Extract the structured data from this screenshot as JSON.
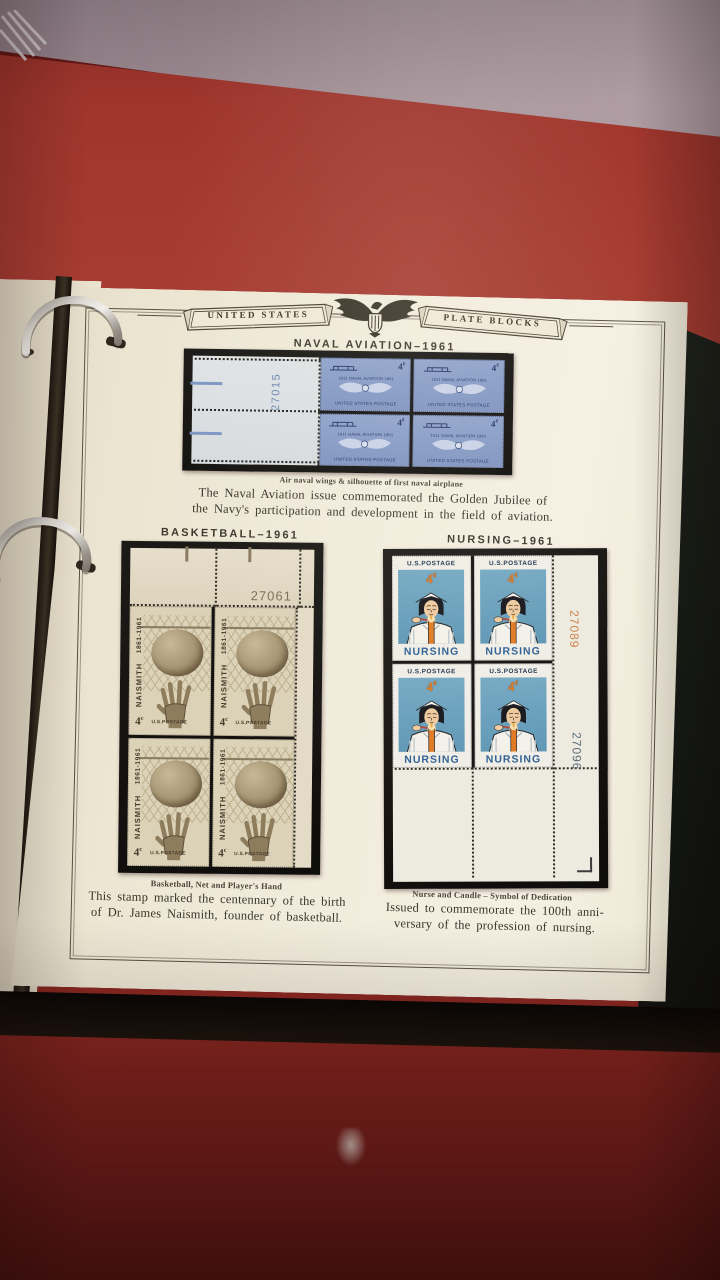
{
  "page_header": {
    "left_banner": "UNITED STATES",
    "right_banner": "PLATE BLOCKS",
    "emblem_icon": "eagle-with-shield"
  },
  "naval_section": {
    "title": "NAVAL AVIATION–1961",
    "plate_number": "27015",
    "stamp": {
      "center_text": "1911 NAVAL AVIATION 1961",
      "denomination": "4",
      "cent_symbol": "¢",
      "bottom_text": "UNITED STATES POSTAGE"
    },
    "caption": "Air naval wings & silhouette of first naval airplane",
    "description_line1": "The Naval Aviation issue commemorated the Golden Jubilee of",
    "description_line2": "the Navy's participation and development in the field of aviation."
  },
  "basketball_section": {
    "title": "BASKETBALL–1961",
    "plate_number": "27061",
    "stamp": {
      "side_years": "1861-1961",
      "side_name": "NAISMITH",
      "denomination": "4",
      "cent_symbol": "c",
      "bottom_text": "U.S.POSTAGE"
    },
    "caption": "Basketball, Net and Player's Hand",
    "description_line1": "This stamp marked the centennary of the birth",
    "description_line2": "of Dr. James Naismith, founder of basketball."
  },
  "nursing_section": {
    "title": "NURSING–1961",
    "plate_number_top": "27089",
    "plate_number_bottom": "27096",
    "stamp": {
      "top_text": "U.S.POSTAGE",
      "denomination": "4",
      "cent_symbol": "¢",
      "name": "NURSING"
    },
    "caption": "Nurse and Candle – Symbol of Dedication",
    "description_line1": "Issued to commemorate the 100th anni-",
    "description_line2": "versary of the profession of nursing."
  },
  "colors": {
    "cloth_red": "#9e352c",
    "wall_mauve": "#a18f95",
    "page_cream": "#efe8d6",
    "mount_black": "#141210",
    "naval_stamp_blue": "#8196c4",
    "naval_ink_navy": "#24356a",
    "naval_plate_blue": "#6d87b6",
    "basketball_sepia": "#8a7a5e",
    "nursing_sky_blue": "#68a0bd",
    "nursing_orange": "#df7a24",
    "nursing_text_blue": "#2e6094",
    "plate_top_orange": "#cd8145",
    "plate_bottom_slate": "#5c6d7a"
  }
}
